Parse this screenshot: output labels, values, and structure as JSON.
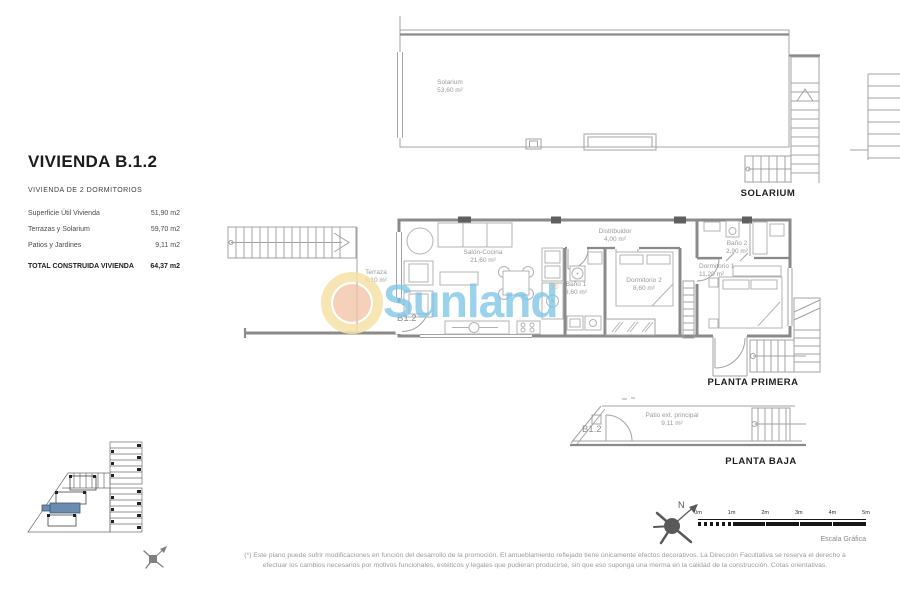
{
  "header": {
    "title": "VIVIENDA B.1.2",
    "subtitle": "VIVIENDA DE 2 DORMITORIOS",
    "areas": [
      {
        "label": "Superficie Útil Vivienda",
        "value": "51,90 m2"
      },
      {
        "label": "Terrazas y Solarium",
        "value": "59,70 m2"
      },
      {
        "label": "Patios y Jardines",
        "value": "9,11 m2"
      }
    ],
    "total": {
      "label": "TOTAL CONSTRUIDA VIVIENDA",
      "value": "64,37 m2"
    }
  },
  "plans": {
    "solarium": {
      "caption": "SOLARIUM",
      "rooms": {
        "solarium": {
          "name": "Solarium",
          "area": "53,60 m²"
        }
      }
    },
    "planta_primera": {
      "caption": "PLANTA PRIMERA",
      "unit_label": "B1.2",
      "rooms": {
        "terraza": {
          "name": "Terraza",
          "area": "6,10 m²"
        },
        "salon_cocina": {
          "name": "Salón-Cocina",
          "area": "21,60 m²"
        },
        "distribuidor": {
          "name": "Distribuidor",
          "area": "4,00 m²"
        },
        "bano1": {
          "name": "Baño 1",
          "area": "3,60 m²"
        },
        "dormitorio2": {
          "name": "Dormitorio 2",
          "area": "8,60 m²"
        },
        "bano2": {
          "name": "Baño 2",
          "area": "2,90 m²"
        },
        "dormitorio1": {
          "name": "Dormitorio 1",
          "area": "11,20 m²"
        }
      }
    },
    "planta_baja": {
      "caption": "PLANTA BAJA",
      "unit_label": "B1.2",
      "rooms": {
        "patio": {
          "name": "Patio ext. principal",
          "area": "9,11 m²"
        }
      }
    }
  },
  "watermark": {
    "text": "Sunland",
    "registered_mark": "®",
    "colors": {
      "text_blue": "#7dc4e6",
      "ring_yellow": "#f6e1a6",
      "inner_peach": "#f2c2a2"
    }
  },
  "compass": {
    "north_label": "N"
  },
  "scale_bar": {
    "ticks": [
      "0m",
      "1m",
      "2m",
      "3m",
      "4m",
      "5m"
    ],
    "caption": "Escala Gráfica"
  },
  "site_plan": {
    "highlight_color": "#6b8cae"
  },
  "disclaimer": {
    "line1": "(*) Este plano puede sufrir modificaciones en función del desarrollo de la promoción. El amueblamiento reflejado tiene únicamente efectos decorativos. La Dirección Facultativa se reserva el derecho a",
    "line2": "efectuar los cambios necesarios por motivos funcionales, estéticos y legales que pudieran producirse, sin que eso suponga una merma en la calidad de la construcción. Cotas orientativas."
  }
}
